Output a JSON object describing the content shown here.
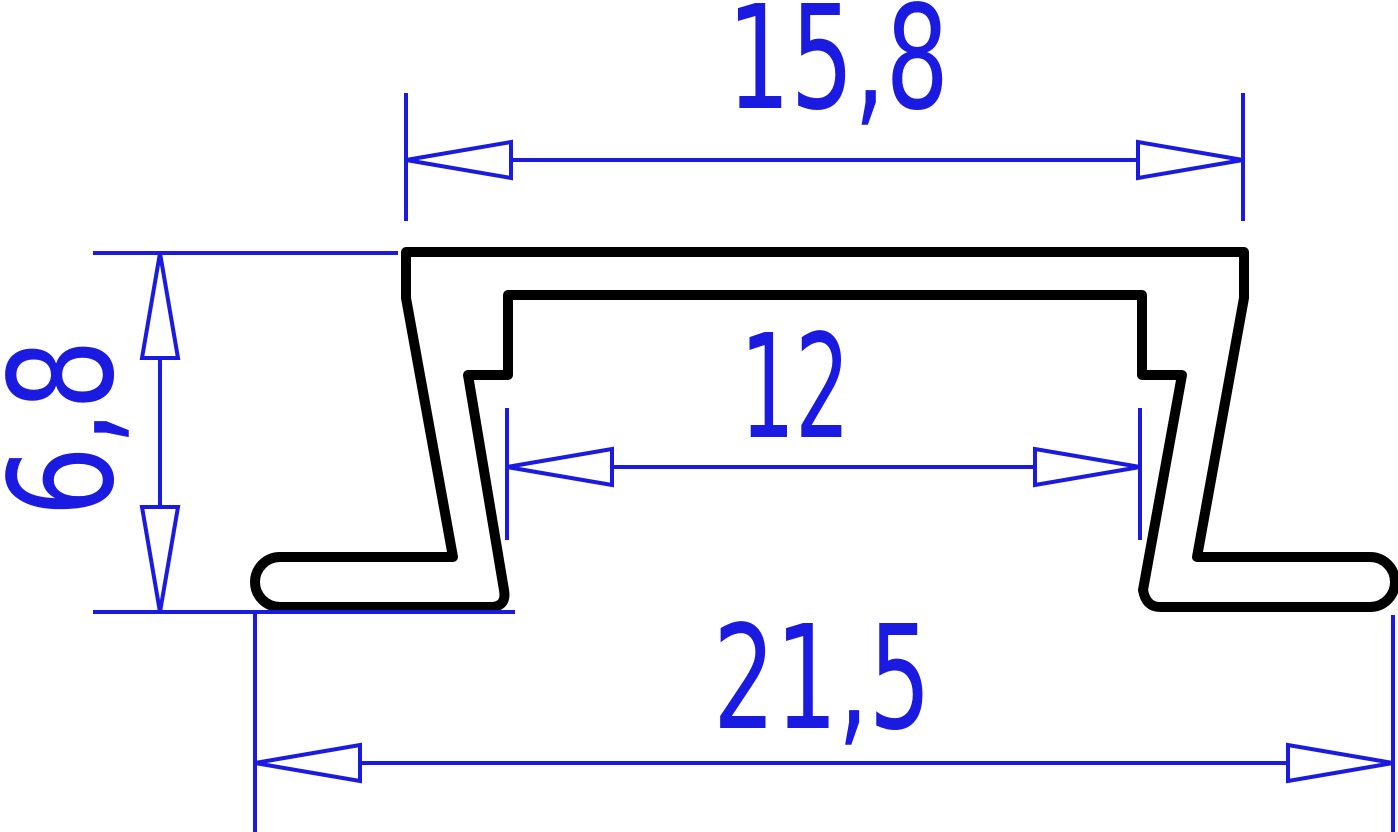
{
  "drawing": {
    "kind": "technical-cross-section",
    "subject": "recessed-led-profile-cross-section",
    "colors": {
      "outline": "#000000",
      "dimension": "#1a1ae0",
      "background": "#ffffff"
    },
    "dimensions": [
      {
        "id": "top-width",
        "label": "15,8",
        "value": 15.8,
        "orientation": "horizontal",
        "position": "top"
      },
      {
        "id": "height",
        "label": "6,8",
        "value": 6.8,
        "orientation": "vertical",
        "position": "left"
      },
      {
        "id": "inner-width",
        "label": "12",
        "value": 12,
        "orientation": "horizontal",
        "position": "middle"
      },
      {
        "id": "bottom-width",
        "label": "21,5",
        "value": 21.5,
        "orientation": "horizontal",
        "position": "bottom"
      }
    ]
  }
}
